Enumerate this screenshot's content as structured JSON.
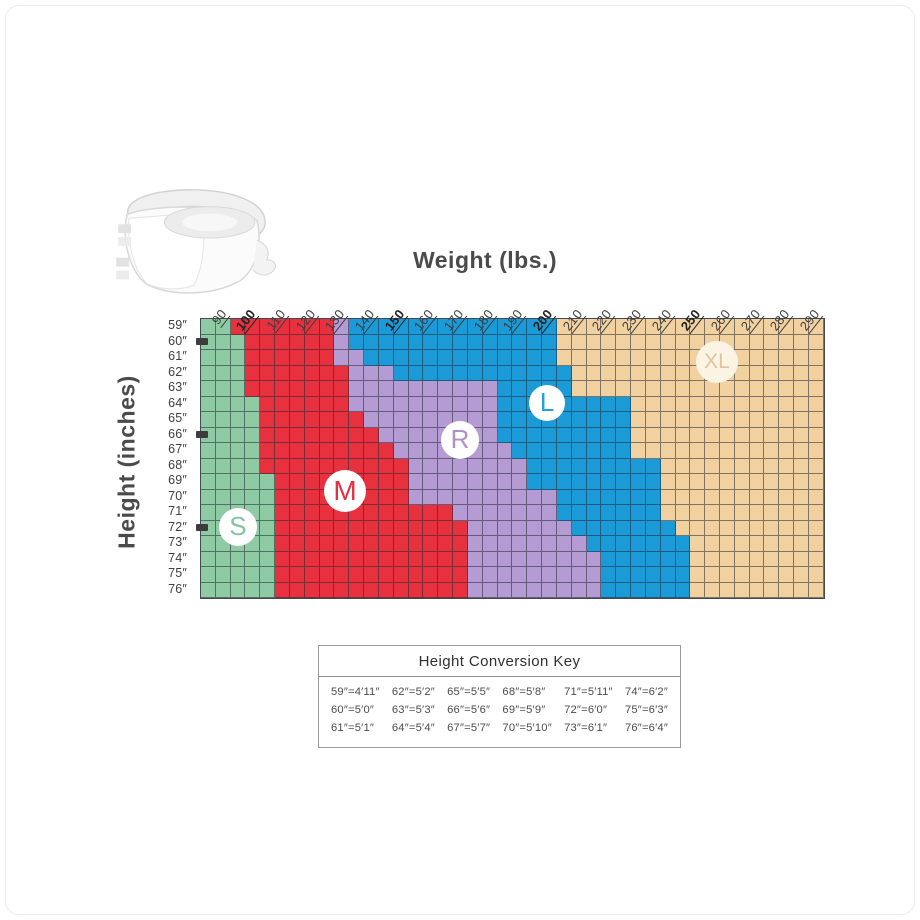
{
  "chart_data": {
    "type": "heatmap",
    "title": "Brief size by height and weight",
    "xlabel": "Weight (lbs.)",
    "ylabel": "Height (inches)",
    "x_ticks": [
      "90",
      "100",
      "110",
      "120",
      "130",
      "140",
      "150",
      "160",
      "170",
      "180",
      "190",
      "200",
      "210",
      "220",
      "230",
      "240",
      "250",
      "260",
      "270",
      "280",
      "290"
    ],
    "x_bold_ticks": [
      "100",
      "150",
      "200",
      "250"
    ],
    "x_start_lbs": 80,
    "lbs_per_cell": 5,
    "columns": 42,
    "y_ticks": [
      "59″",
      "60″",
      "61″",
      "62″",
      "63″",
      "64″",
      "65″",
      "66″",
      "67″",
      "68″",
      "69″",
      "70″",
      "71″",
      "72″",
      "75″",
      "76″"
    ],
    "y_ticks_full": [
      "59″",
      "60″",
      "61″",
      "62″",
      "63″",
      "64″",
      "65″",
      "66″",
      "67″",
      "68″",
      "69″",
      "70″",
      "71″",
      "72″",
      "73″",
      "74″",
      "75″",
      "76″"
    ],
    "y_marker_ticks": [
      "60″",
      "66″",
      "72″"
    ],
    "grid_color": "rgba(32,40,50,0.55)",
    "size_colors": {
      "S": "#8ecaa3",
      "M": "#e8313f",
      "R": "#b59bd3",
      "L": "#1b9ad8",
      "XL": "#f2d1a0"
    },
    "size_letter_colors": {
      "S": "#84c4a0",
      "M": "#e23140",
      "R": "#ae90cc",
      "L": "#259fdd",
      "XL": "#dfc49c"
    },
    "badge_fills": {
      "S": "#ffffff",
      "M": "#ffffff",
      "R": "#ffffff",
      "L": "#ffffff",
      "XL": "#fbf4e4"
    },
    "rows": [
      {
        "h": "59″",
        "segs": [
          [
            "S",
            2
          ],
          [
            "M",
            7
          ],
          [
            "R",
            1
          ],
          [
            "L",
            14
          ],
          [
            "XL",
            18
          ]
        ]
      },
      {
        "h": "60″",
        "segs": [
          [
            "S",
            3
          ],
          [
            "M",
            6
          ],
          [
            "R",
            1
          ],
          [
            "L",
            14
          ],
          [
            "XL",
            18
          ]
        ]
      },
      {
        "h": "61″",
        "segs": [
          [
            "S",
            3
          ],
          [
            "M",
            6
          ],
          [
            "R",
            2
          ],
          [
            "L",
            13
          ],
          [
            "XL",
            18
          ]
        ]
      },
      {
        "h": "62″",
        "segs": [
          [
            "S",
            3
          ],
          [
            "M",
            7
          ],
          [
            "R",
            3
          ],
          [
            "L",
            12
          ],
          [
            "XL",
            17
          ]
        ]
      },
      {
        "h": "63″",
        "segs": [
          [
            "S",
            3
          ],
          [
            "M",
            7
          ],
          [
            "R",
            10
          ],
          [
            "L",
            5
          ],
          [
            "XL",
            17
          ]
        ]
      },
      {
        "h": "64″",
        "segs": [
          [
            "S",
            4
          ],
          [
            "M",
            6
          ],
          [
            "R",
            10
          ],
          [
            "L",
            9
          ],
          [
            "XL",
            13
          ]
        ]
      },
      {
        "h": "65″",
        "segs": [
          [
            "S",
            4
          ],
          [
            "M",
            7
          ],
          [
            "R",
            9
          ],
          [
            "L",
            9
          ],
          [
            "XL",
            13
          ]
        ]
      },
      {
        "h": "66″",
        "segs": [
          [
            "S",
            4
          ],
          [
            "M",
            8
          ],
          [
            "R",
            8
          ],
          [
            "L",
            9
          ],
          [
            "XL",
            13
          ]
        ]
      },
      {
        "h": "67″",
        "segs": [
          [
            "S",
            4
          ],
          [
            "M",
            9
          ],
          [
            "R",
            8
          ],
          [
            "L",
            8
          ],
          [
            "XL",
            13
          ]
        ]
      },
      {
        "h": "68″",
        "segs": [
          [
            "S",
            4
          ],
          [
            "M",
            10
          ],
          [
            "R",
            8
          ],
          [
            "L",
            9
          ],
          [
            "XL",
            11
          ]
        ]
      },
      {
        "h": "69″",
        "segs": [
          [
            "S",
            5
          ],
          [
            "M",
            9
          ],
          [
            "R",
            8
          ],
          [
            "L",
            9
          ],
          [
            "XL",
            11
          ]
        ]
      },
      {
        "h": "70″",
        "segs": [
          [
            "S",
            5
          ],
          [
            "M",
            9
          ],
          [
            "R",
            10
          ],
          [
            "L",
            7
          ],
          [
            "XL",
            11
          ]
        ]
      },
      {
        "h": "71″",
        "segs": [
          [
            "S",
            5
          ],
          [
            "M",
            12
          ],
          [
            "R",
            7
          ],
          [
            "L",
            7
          ],
          [
            "XL",
            11
          ]
        ]
      },
      {
        "h": "72″",
        "segs": [
          [
            "S",
            5
          ],
          [
            "M",
            13
          ],
          [
            "R",
            7
          ],
          [
            "L",
            7
          ],
          [
            "XL",
            10
          ]
        ]
      },
      {
        "h": "73″",
        "segs": [
          [
            "S",
            5
          ],
          [
            "M",
            13
          ],
          [
            "R",
            8
          ],
          [
            "L",
            7
          ],
          [
            "XL",
            9
          ]
        ]
      },
      {
        "h": "74″",
        "segs": [
          [
            "S",
            5
          ],
          [
            "M",
            13
          ],
          [
            "R",
            9
          ],
          [
            "L",
            6
          ],
          [
            "XL",
            9
          ]
        ]
      },
      {
        "h": "75″",
        "segs": [
          [
            "S",
            5
          ],
          [
            "M",
            13
          ],
          [
            "R",
            9
          ],
          [
            "L",
            6
          ],
          [
            "XL",
            9
          ]
        ]
      },
      {
        "h": "76″",
        "segs": [
          [
            "S",
            5
          ],
          [
            "M",
            13
          ],
          [
            "R",
            9
          ],
          [
            "L",
            6
          ],
          [
            "XL",
            9
          ]
        ]
      }
    ],
    "size_labels": [
      {
        "text": "S",
        "col": 2.56,
        "rowf": 13.48,
        "r": 19,
        "fs": 26
      },
      {
        "text": "M",
        "col": 9.78,
        "rowf": 11.16,
        "r": 21,
        "fs": 28
      },
      {
        "text": "R",
        "col": 17.53,
        "rowf": 7.87,
        "r": 19,
        "fs": 26
      },
      {
        "text": "L",
        "col": 23.4,
        "rowf": 5.48,
        "r": 18,
        "fs": 26
      },
      {
        "text": "XL",
        "col": 34.85,
        "rowf": 2.84,
        "r": 21,
        "fs": 21
      }
    ]
  },
  "conversion_key": {
    "title": "Height Conversion Key",
    "columns": [
      [
        "59″=4′11″",
        "60″=5′0″",
        "61″=5′1″"
      ],
      [
        "62″=5′2″",
        "63″=5′3″",
        "64″=5′4″"
      ],
      [
        "65″=5′5″",
        "66″=5′6″",
        "67″=5′7″"
      ],
      [
        "68″=5′8″",
        "69″=5′9″",
        "70″=5′10″"
      ],
      [
        "71″=5′11″",
        "72″=6′0″",
        "73″=6′1″"
      ],
      [
        "74″=6′2″",
        "75″=6′3″",
        "76″=6′4″"
      ]
    ]
  }
}
